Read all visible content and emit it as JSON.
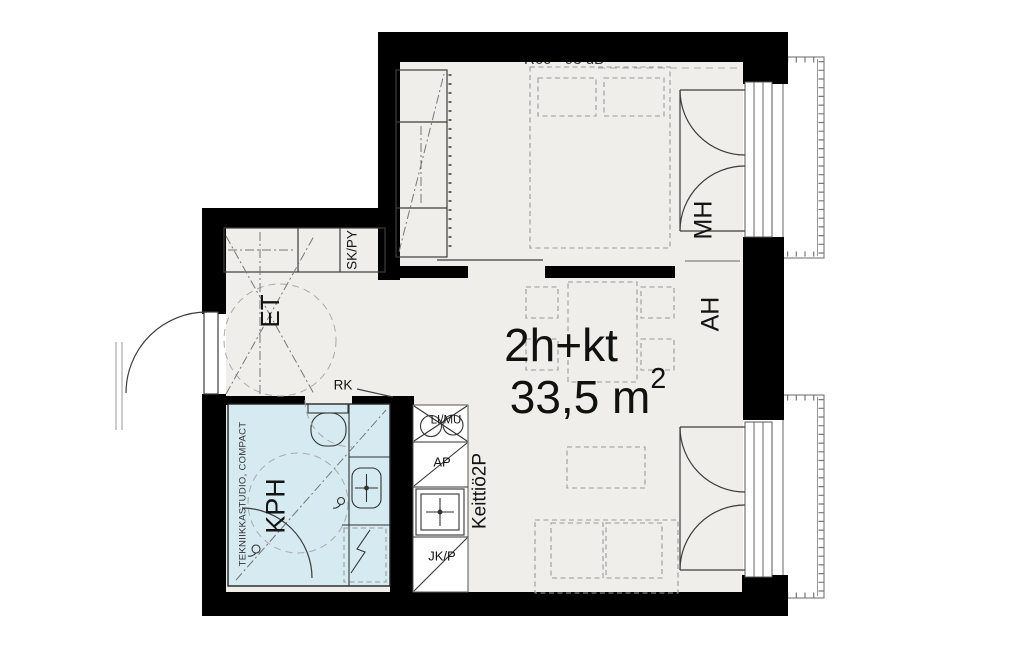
{
  "plan": {
    "unit_type": "2h+kt",
    "area_value": "33,5 m",
    "area_exponent": "2",
    "sound_note": "R60 - 93 dB",
    "labels": {
      "bedroom": "MH",
      "living_room": "AH",
      "entry": "ET",
      "bathroom": "KPH",
      "cleaning_closet": "SK/PY",
      "kitchen": "Keittiö2P",
      "electrical_cabinet": "RK",
      "stove_microwave": "LI/MU",
      "dishwasher": "AP",
      "fridge_freezer": "JK/P",
      "bathroom_module": "TEKNIIKKASTUDIO, COMPACT"
    },
    "colors": {
      "wall": "#000000",
      "floor": "#f0eeeb",
      "bathroom": "#d6eaf2",
      "line": "#3c3c3c",
      "furniture": "#9a9a9a"
    }
  }
}
